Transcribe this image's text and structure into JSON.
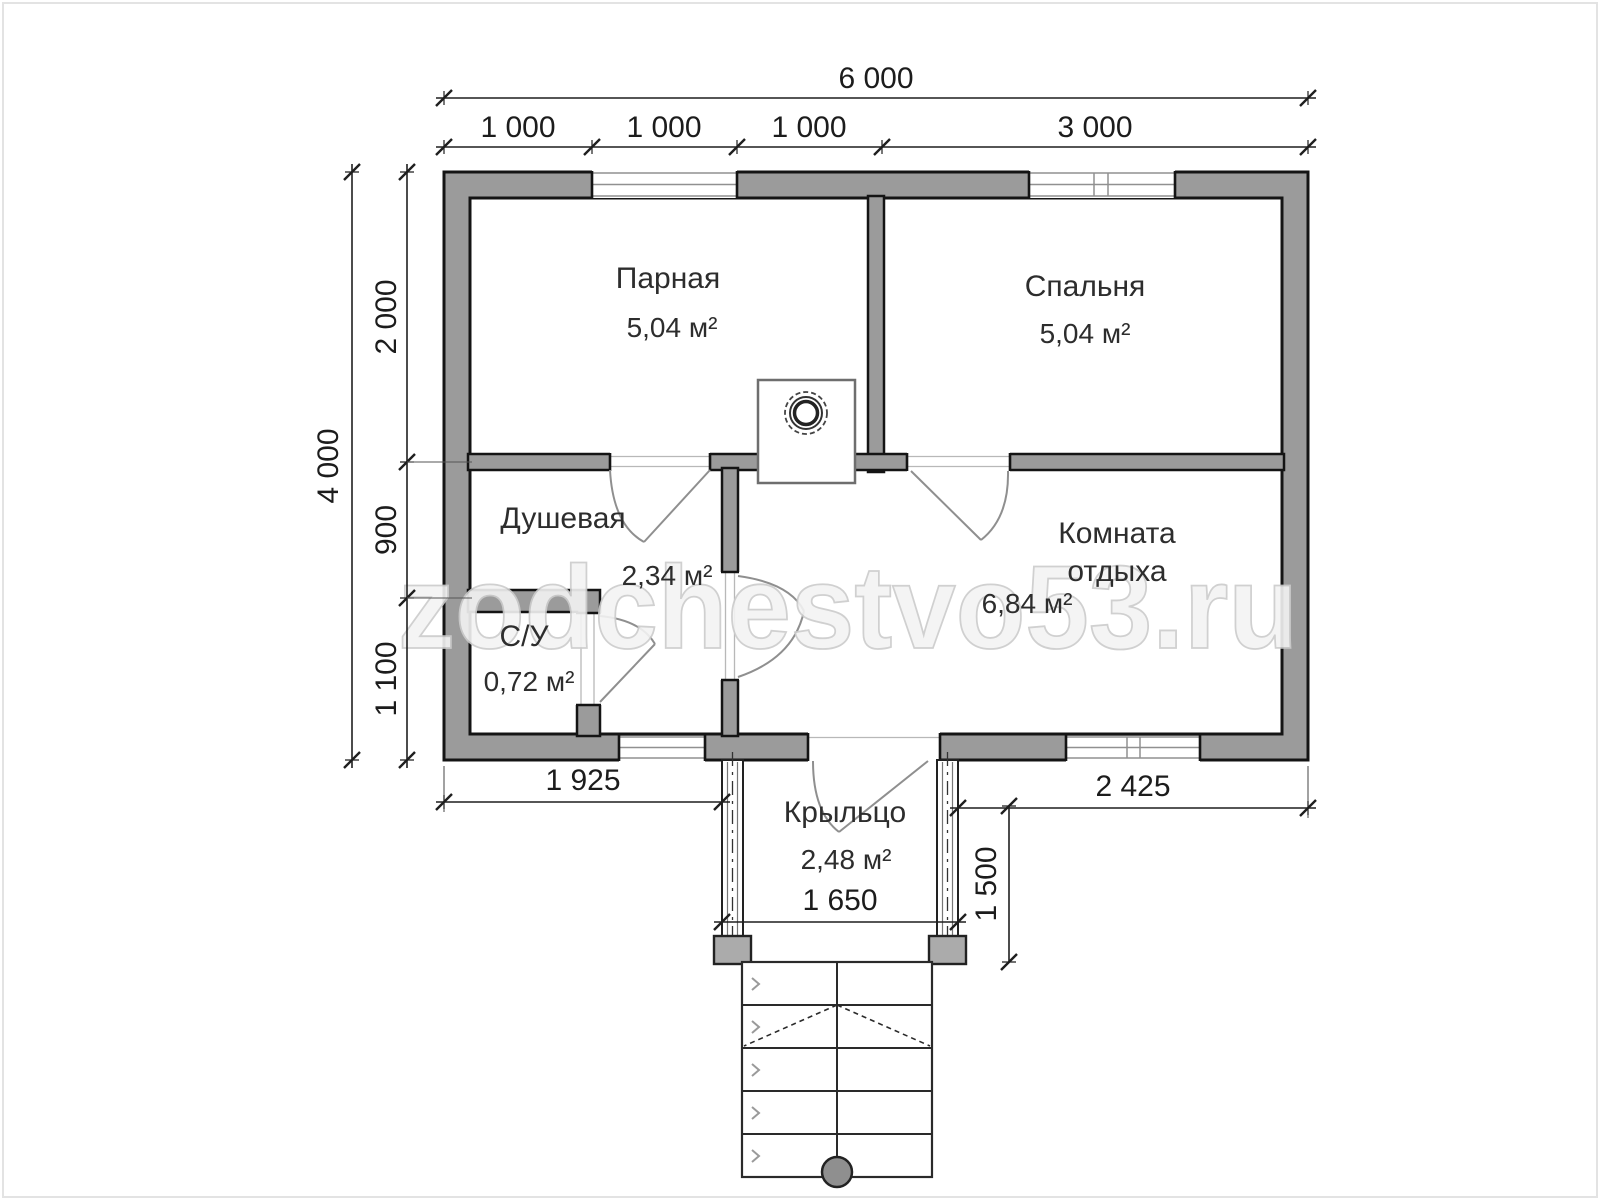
{
  "watermark": "zodchestvo53.ru",
  "rooms": [
    {
      "name": "Парная",
      "area": "5,04 м²"
    },
    {
      "name": "Спальня",
      "area": "5,04 м²"
    },
    {
      "name": "Душевая",
      "area": "2,34 м²"
    },
    {
      "name": "С/У",
      "area": "0,72 м²"
    },
    {
      "name": "Комната отдыха",
      "name_lines": [
        "Комната",
        "отдыха"
      ],
      "area": "6,84 м²"
    },
    {
      "name": "Крыльцо",
      "area": "2,48 м²"
    }
  ],
  "dimensions": {
    "top_total": "6 000",
    "top_segments": [
      "1 000",
      "1 000",
      "1 000",
      "3 000"
    ],
    "left_total": "4 000",
    "left_segments": [
      "2 000",
      "900",
      "1 100"
    ],
    "bottom_left": "1 925",
    "bottom_right": "2 425",
    "porch_width": "1 650",
    "porch_depth": "1 500"
  },
  "colors": {
    "wall_fill": "#9b9b9b",
    "outline": "#141414",
    "dimension_lines": "#1f1f1f",
    "watermark": "#f3f3f3"
  }
}
